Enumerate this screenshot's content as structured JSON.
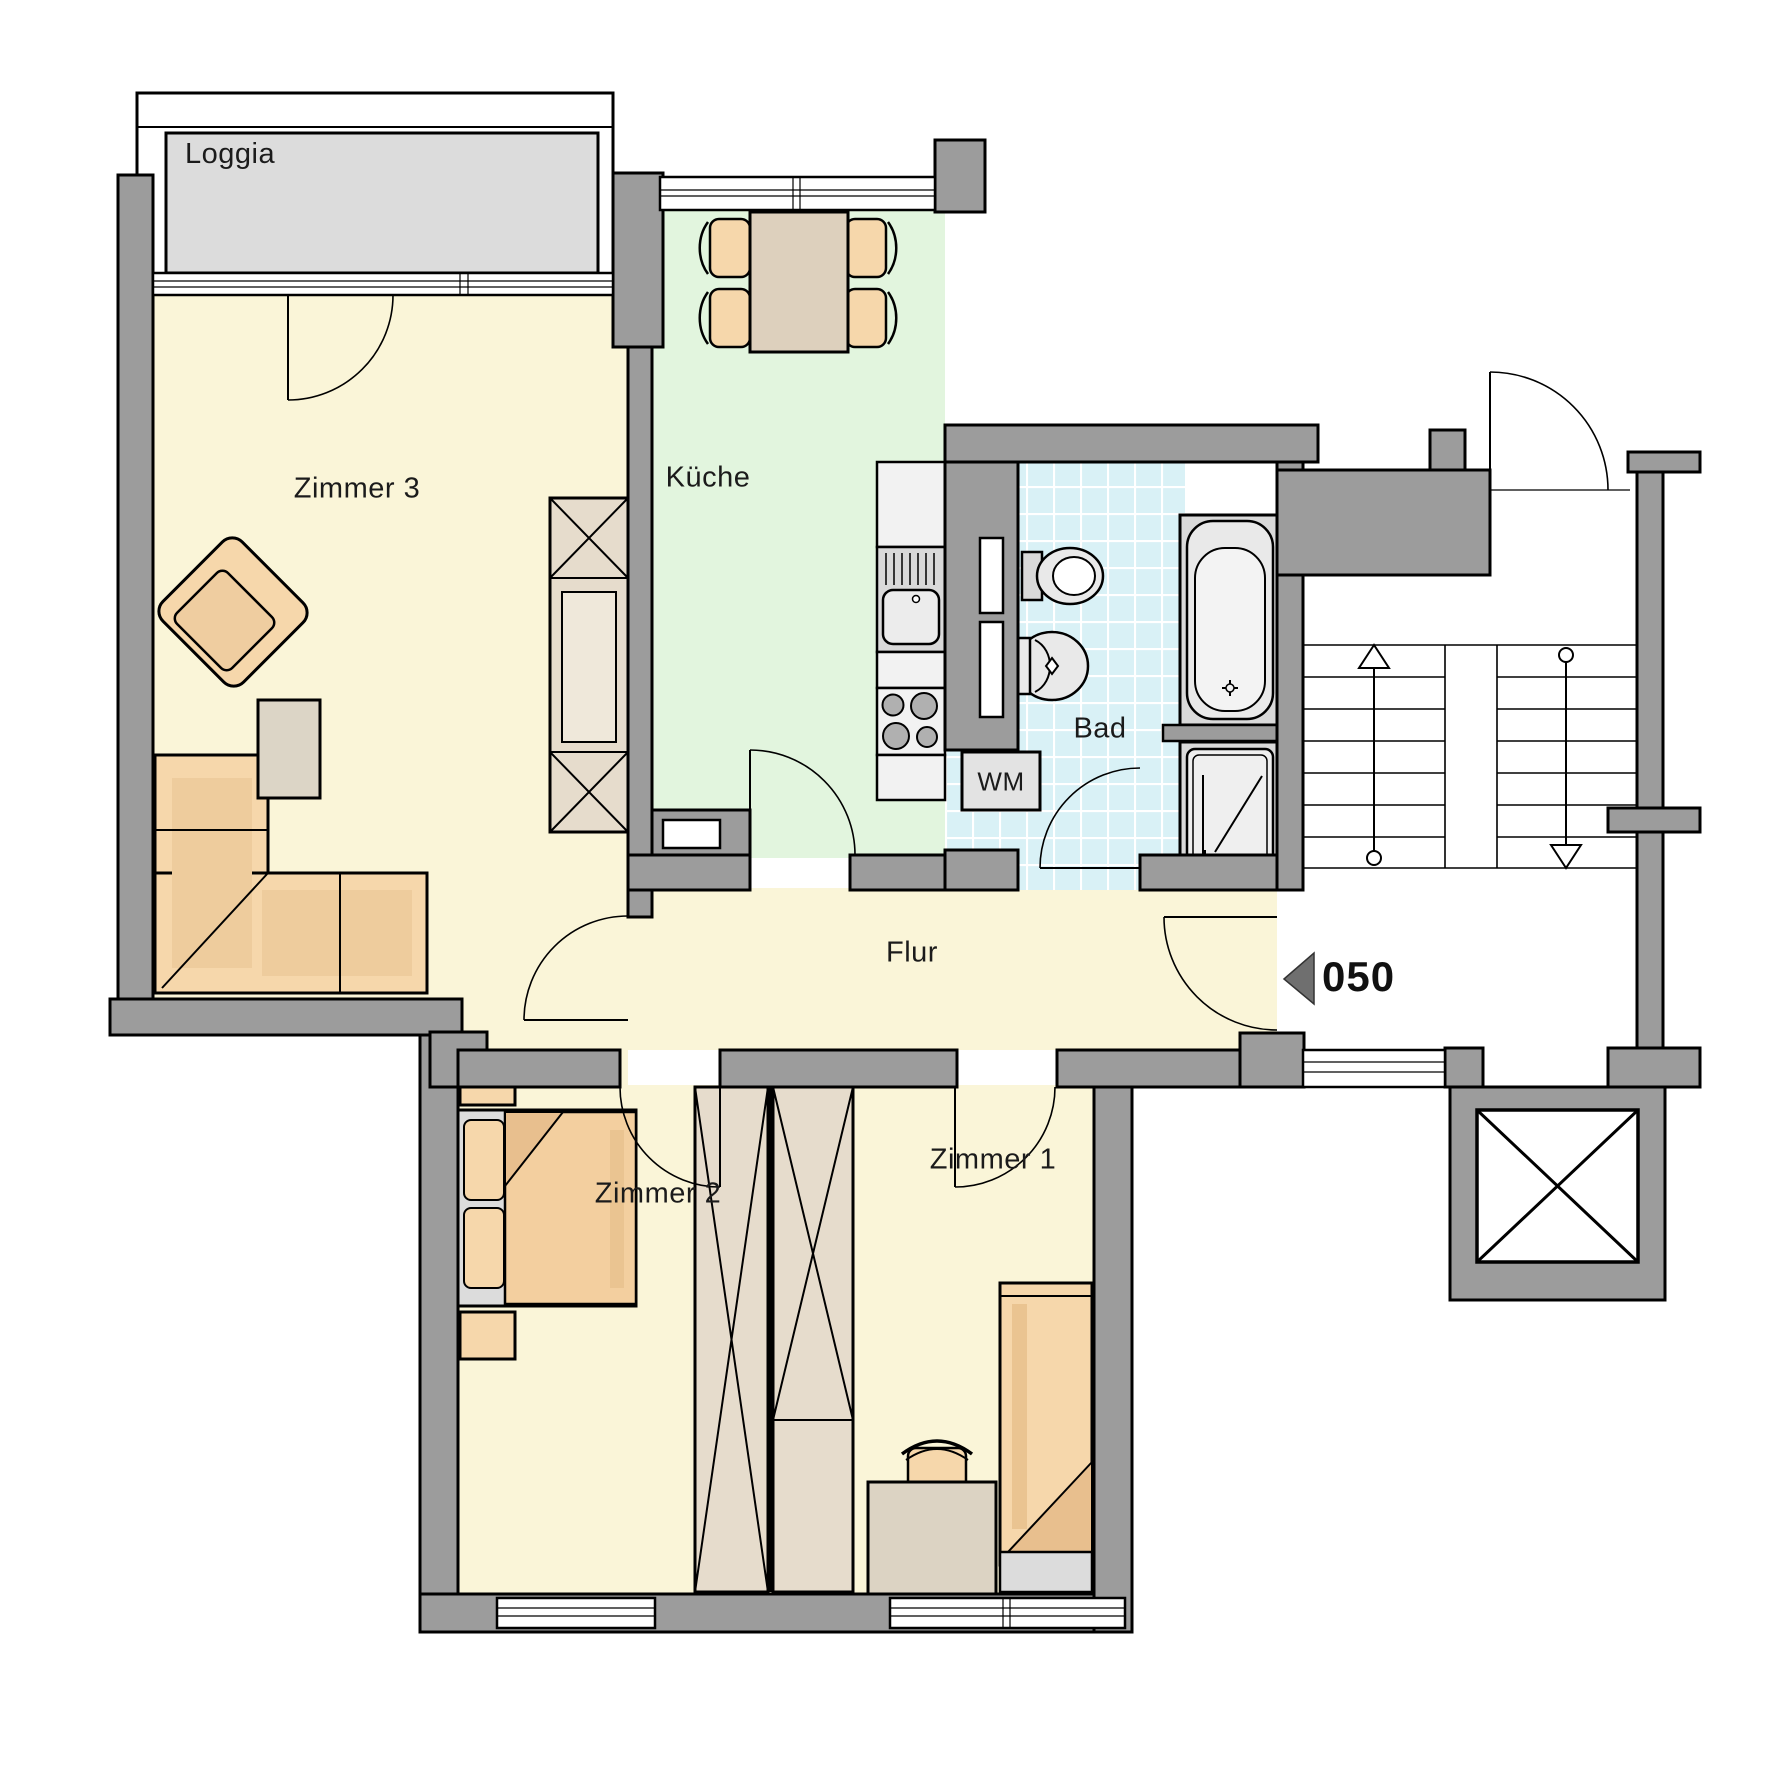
{
  "plan": {
    "title": "Apartment floor plan",
    "unit_number": "050",
    "rooms": {
      "loggia": {
        "label": "Loggia"
      },
      "zimmer3": {
        "label": "Zimmer 3"
      },
      "kueche": {
        "label": "Küche"
      },
      "bad": {
        "label": "Bad"
      },
      "wm": {
        "label": "WM"
      },
      "flur": {
        "label": "Flur"
      },
      "zimmer2": {
        "label": "Zimmer 2"
      },
      "zimmer1": {
        "label": "Zimmer 1"
      }
    },
    "colors": {
      "wall_gray": "#9c9c9c",
      "room_yellow": "#faf5d8",
      "kitchen_green": "#e2f5de",
      "bath_cyan": "#d9f1f6",
      "loggia_floor_gray": "#dcdcdc",
      "furniture_peach": "#f6d7ab",
      "furniture_shade": "#eecc9d",
      "furniture_tan": "#ddd0bd",
      "wardrobe_beige": "#e6dccc",
      "fixture_gray": "#e9e9e9",
      "entry_arrow_gray": "#6f6f6f",
      "line_black": "#000000"
    }
  }
}
